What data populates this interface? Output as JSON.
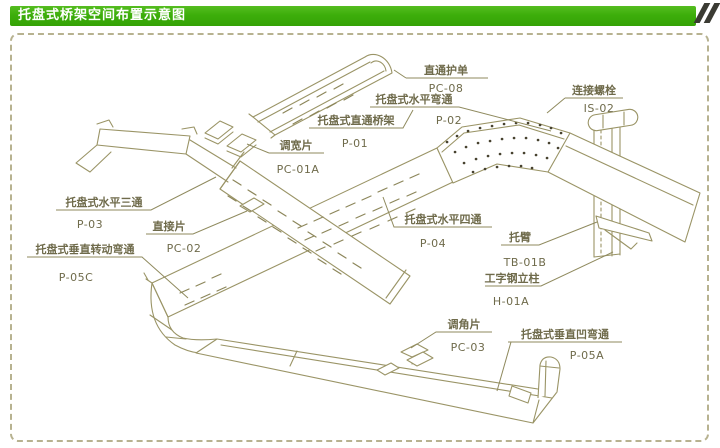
{
  "header": {
    "title": "托盘式桥架空间布置示意图"
  },
  "colors": {
    "header_green": "#3dae0b",
    "slash_dark": "#3b3b33",
    "line_olive": "#9a9466",
    "text_olive": "#6f6b4b",
    "frame_dash": "#b7b290",
    "texture_dot": "#47422f"
  },
  "labels": [
    {
      "name": "直通护单",
      "code": "PC-08"
    },
    {
      "name": "托盘式水平弯通",
      "code": "P-02"
    },
    {
      "name": "托盘式直通桥架",
      "code": "P-01"
    },
    {
      "name": "调宽片",
      "code": "PC-01A"
    },
    {
      "name": "连接螺栓",
      "code": "IS-02"
    },
    {
      "name": "托盘式水平三通",
      "code": "P-03"
    },
    {
      "name": "直接片",
      "code": "PC-02"
    },
    {
      "name": "托盘式垂直转动弯通",
      "code": "P-05C"
    },
    {
      "name": "托盘式水平四通",
      "code": "P-04"
    },
    {
      "name": "托臂",
      "code": "TB-01B"
    },
    {
      "name": "工字钢立柱",
      "code": "H-01A"
    },
    {
      "name": "调角片",
      "code": "PC-03"
    },
    {
      "name": "托盘式垂直凹弯通",
      "code": "P-05A"
    }
  ]
}
